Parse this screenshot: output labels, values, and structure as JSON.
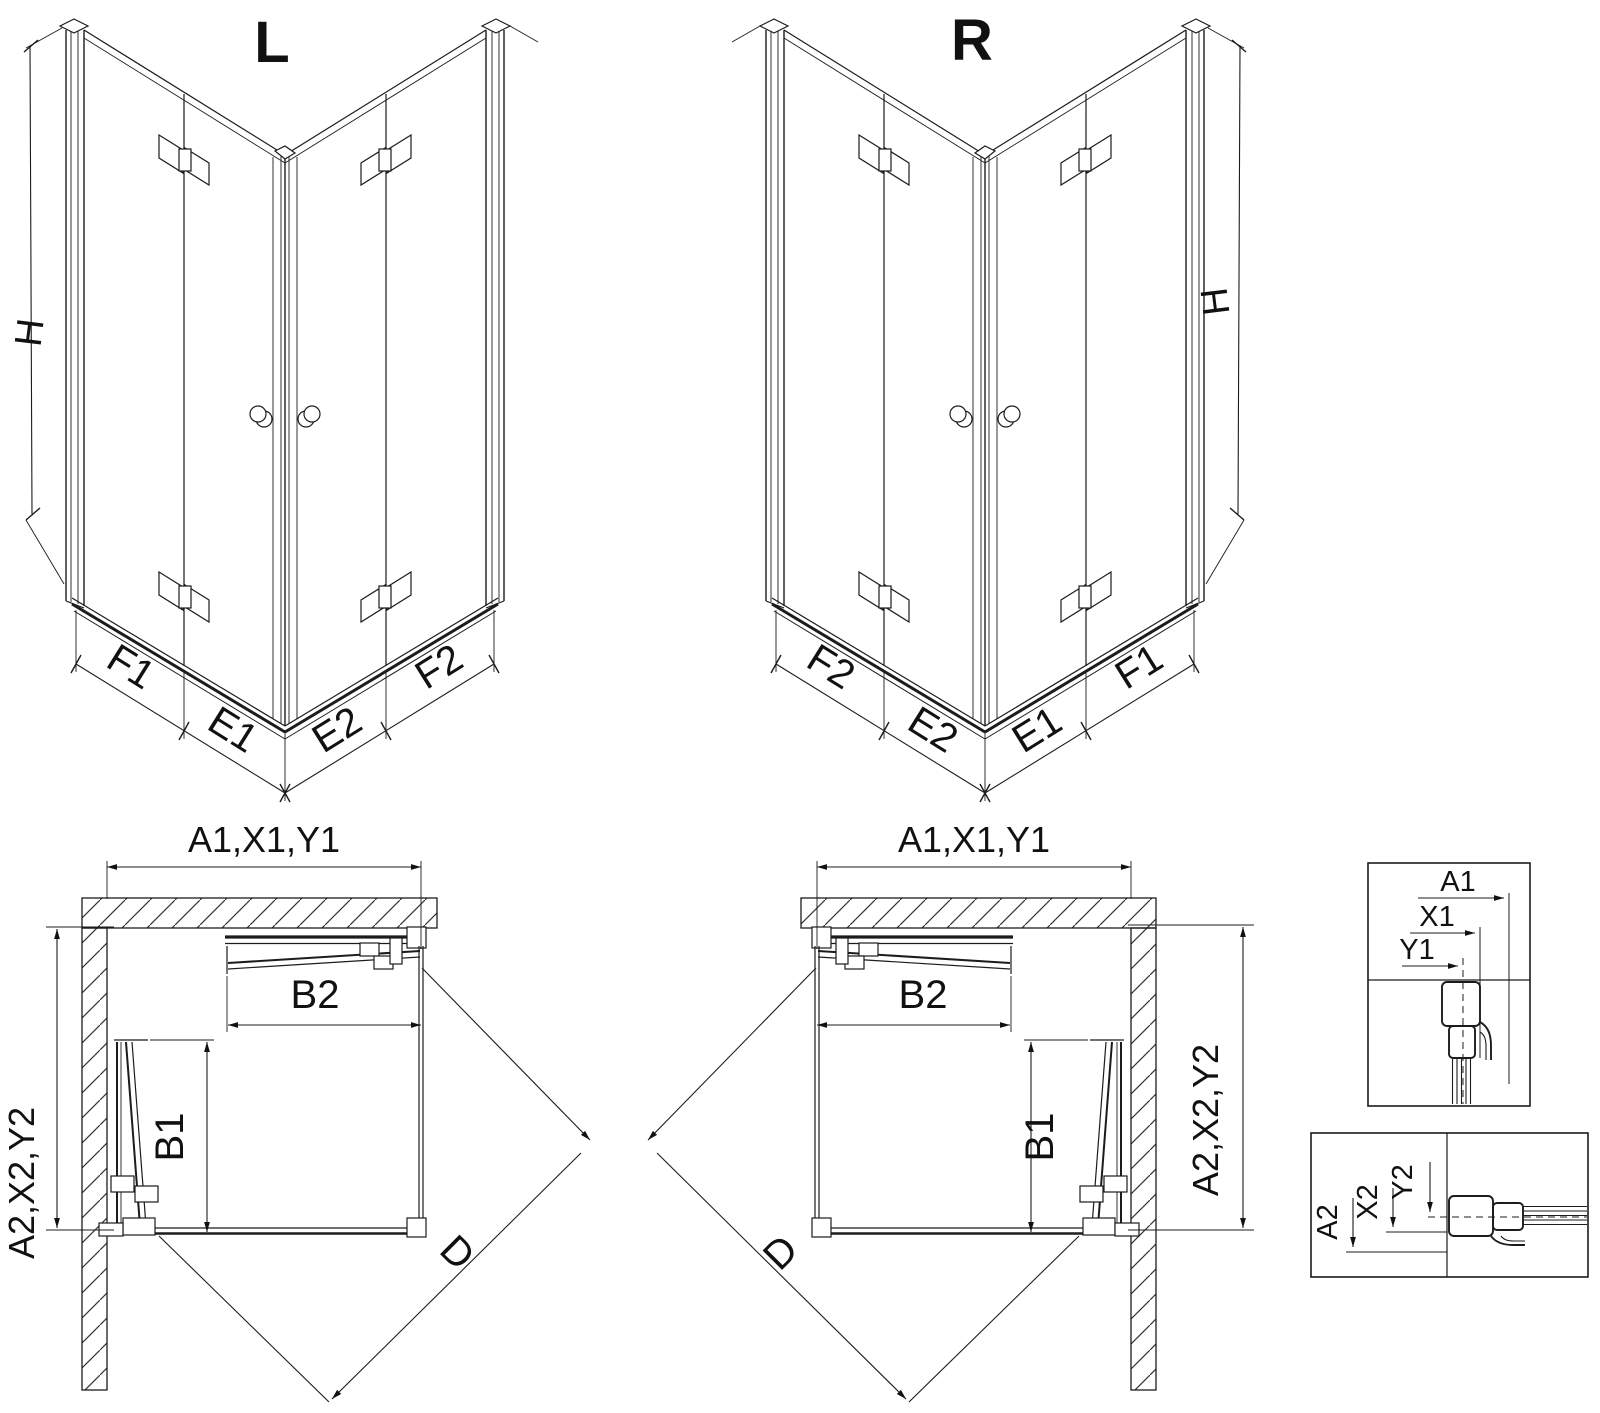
{
  "background": "#ffffff",
  "line_color": "#1c1c1c",
  "iso_left": {
    "title": "L",
    "height_label": "H",
    "segments": [
      "F1",
      "E1",
      "E2",
      "F2"
    ]
  },
  "iso_right": {
    "title": "R",
    "height_label": "H",
    "segments": [
      "F2",
      "E2",
      "E1",
      "F1"
    ]
  },
  "plan_left": {
    "width_label": "A1,X1,Y1",
    "depth_label": "A2,X2,Y2",
    "door_top": "B2",
    "door_side": "B1",
    "diagonal": "D"
  },
  "plan_right": {
    "width_label": "A1,X1,Y1",
    "depth_label": "A2,X2,Y2",
    "door_top": "B2",
    "door_side": "B1",
    "diagonal": "D"
  },
  "detail_width": {
    "labels": [
      "A1",
      "X1",
      "Y1"
    ]
  },
  "detail_depth": {
    "labels": [
      "A2",
      "X2",
      "Y2"
    ]
  }
}
